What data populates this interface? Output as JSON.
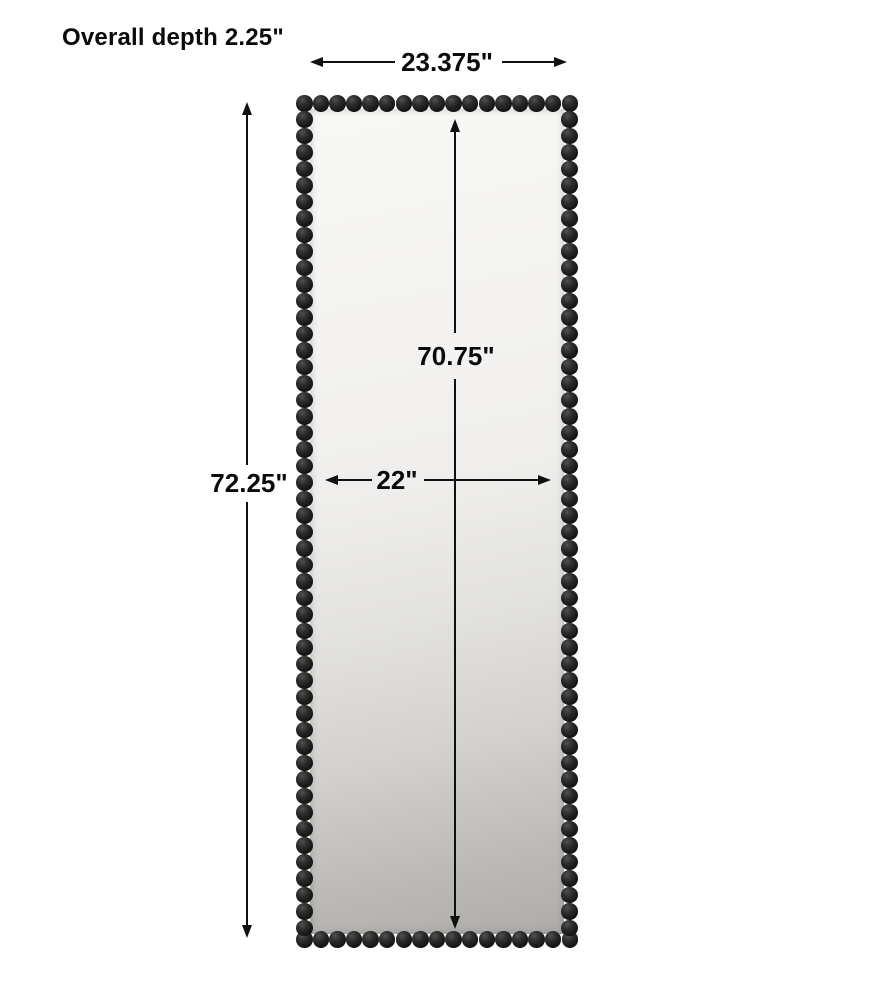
{
  "labels": {
    "overall_depth": "Overall depth 2.25\"",
    "overall_width": "23.375\"",
    "overall_height": "72.25\"",
    "inner_height": "70.75\"",
    "inner_width": "22\""
  },
  "product": {
    "type": "beaded-frame-floor-mirror"
  },
  "colors": {
    "background": "#ffffff",
    "dimension_line": "#101010",
    "text": "#0b0b0b",
    "bead_dark": "#0a0a0a",
    "bead_highlight": "#515151",
    "mirror_light": "#f8f8f6",
    "mirror_dark": "#aeacaa"
  }
}
